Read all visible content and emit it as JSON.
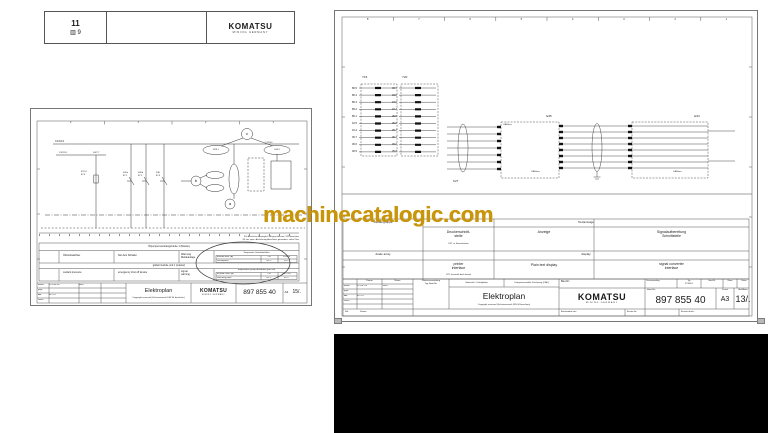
{
  "watermark": {
    "text": "machinecatalogic.com",
    "color": "#c8950b"
  },
  "header_card": {
    "number": "11",
    "book_ref": "9",
    "brand": "KOMATSU",
    "brand_sub": "MINING GERMANY"
  },
  "left_page": {
    "cols": [
      "4",
      "3",
      "2",
      "1"
    ],
    "bus_label": "C1/X4.6",
    "wire_label_left": "X1/X2.6",
    "wire_label_right": "X4/7.7",
    "comp_left": "B7.10\n87.4",
    "comp_labels": [
      "S20a\n87.1",
      "S20b\n87.2",
      "S30\n87.4"
    ],
    "callout_a": "a",
    "callout_b": "b",
    "callout_c": "c",
    "ellipse_left": "B25.1",
    "ellipse_right": "X40.2",
    "ellipse_right_top": "C1/X40",
    "note1": "X4: Anschluss Analogteil 1/A geschlossen, X25 beachten",
    "note2": "X5: bei spez. Ausführung Anschluss gesondert, siehe Plan",
    "table": {
      "band_de": "Ölpumpenverteilergetriebe 1 (Master)",
      "de": [
        "Öldruckwächter",
        "Not-Aus Schalter",
        "Warnung\nMeldeanlage"
      ],
      "mini_de_title": "Temperatur Gerätebehälter",
      "mini_de": [
        [
          "Einsatz max. (A)",
          "1 B",
          "24V-48"
        ],
        [
          "Schaltpunkt",
          "60°C",
          "95°C"
        ]
      ],
      "band_en": "global module unit 1 (master)",
      "en": [
        "coolant pressure",
        "emergency shut off device",
        "signal\nwarning"
      ],
      "mini_en_title": "temperature pump distributor gear unit",
      "mini_en": [
        [
          "oil prob. max. (A)",
          "1 B",
          "097-750"
        ],
        [
          "switching point",
          "60°C",
          "95°C"
        ]
      ]
    },
    "tb": {
      "rows": [
        [
          "bearb.",
          "11-JUN-98",
          "Baer"
        ],
        [
          "gepr.",
          "",
          ""
        ],
        [
          "Abt.",
          "8121.4",
          ""
        ],
        [
          "Norm",
          "",
          ""
        ]
      ],
      "title": "Elektroplan",
      "copyright": "Copyright reserved (Schutzvermerk DIN 34 beachten)",
      "brand": "KOMATSU",
      "brand_sub": "MINING GERMANY",
      "ident": "897 855 40",
      "format": "A3",
      "sheet": "15/."
    }
  },
  "right_page": {
    "cols": [
      "8",
      "7",
      "6",
      "5",
      "4",
      "3",
      "2",
      "1"
    ],
    "y15": {
      "label": "Y15",
      "refs": [
        "86.5",
        "86.4",
        "86.3",
        "86.2",
        "86.1",
        "16.5",
        "16.4",
        "36.7",
        "36.6",
        "36.5"
      ]
    },
    "y20": {
      "label": "Y20",
      "refs": [
        "33.7",
        "33.6",
        "34.6",
        "34.7",
        "35.5",
        "35.6",
        "35.7",
        "36.7",
        "36.6",
        "35.6"
      ]
    },
    "k27": {
      "label": "K27"
    },
    "e35": {
      "label": "E35",
      "bus_top": "CAN-bus",
      "bus_bottom": "CAN-bus"
    },
    "e34": {
      "label": "E34",
      "bus": "CAN-bus"
    },
    "table": {
      "col1_de": "Diodengruppe",
      "header_span": "Textanzeige",
      "de": [
        "Druckerschnitt-\nstelle",
        "Anzeige",
        "Signalaufbereitung\nSchnittstelle"
      ],
      "note_de": "K27: in Steuerkasten",
      "col1_en": "diode array",
      "band_en": "display",
      "en": [
        "printer\ninterface",
        "Plain text display",
        "signal converter\ninterface"
      ],
      "note_en": "K27: beneath dash board"
    },
    "tb": {
      "h_datum": "Datum",
      "h_name": "Name",
      "rows": [
        [
          "bearb.",
          "11-JUL-00",
          "Baer"
        ],
        [
          "gepr.",
          "",
          ""
        ],
        [
          "Abt.",
          "8121.4",
          ""
        ],
        [
          "Norm",
          "",
          ""
        ]
      ],
      "bl1": "Stk.",
      "bl2": "Datum",
      "usage": "Weiterverwendung",
      "usage_sub": "Typ      Ident-Nr.",
      "cad1": "Gedruckt f. Schaltpläne",
      "cad2": "Computererstellte Zeichnung (CAD)",
      "title": "Elektroplan",
      "copyright": "Copyright reserved (Schutzvermerk DIN 34 beachten)",
      "bau": "Bau-Nr.:",
      "brand": "KOMATSU",
      "brand_sub": "MINING GERMANY",
      "first_use": "Erstverwendung",
      "typ_label": "Typ",
      "typ": "PC3000-1",
      "ident_label": "Ident-Nr.",
      "name_label": "Name",
      "datum_label": "Datum",
      "ident_small": "Ident-Nr.:",
      "ident": "897 855 40",
      "format_label": "Format",
      "format": "A3",
      "sheet_label": "Blatt/Blätter",
      "sheet": "13/.",
      "from": "Entstanden aus:",
      "replaces": "Ersatz für:",
      "replaced_by": "Ersetzt durch:"
    }
  }
}
